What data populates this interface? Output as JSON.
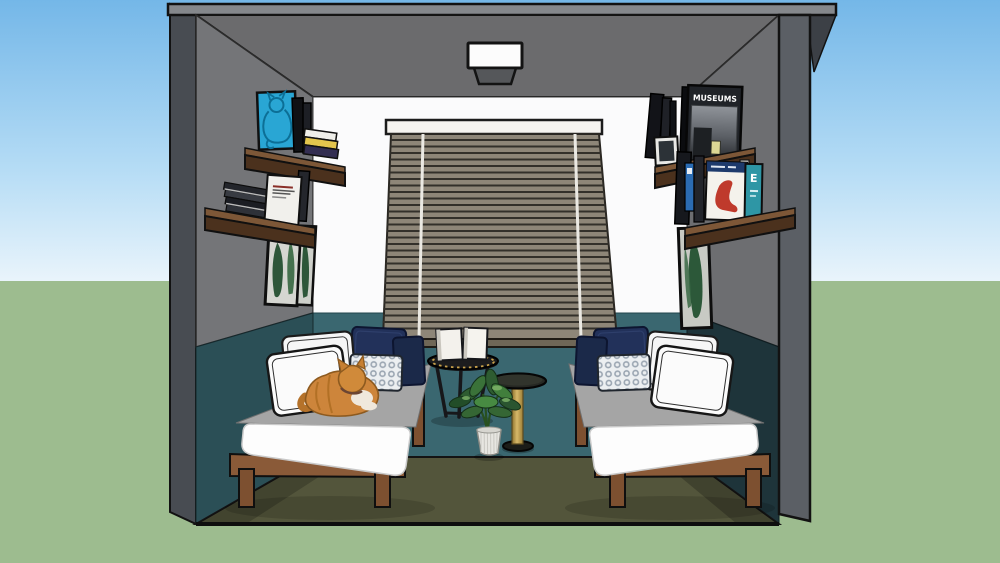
{
  "meta": {
    "scene_title": "Guest bedroom with twin daybeds — 3D dollhouse cutaway render",
    "render_style": "sketchup-like flat shading with black edge lines"
  },
  "environment": {
    "sky_top": "#74b7e8",
    "sky_mid": "#b5dcf5",
    "sky_horizon": "#e9f4fb",
    "ground": "#9dbc8f",
    "horizon_y_px": 281
  },
  "room": {
    "ceiling_color": "#6b6b6d",
    "side_wall_upper_color": "#747578",
    "back_wall_color": "#fbfbfc",
    "wainscot_back_color": "#3a6770",
    "wainscot_left_color": "#2b4f56",
    "wainscot_right_color": "#1e343a",
    "floor_color": "#53553b",
    "exterior_wall_color": "#484c52",
    "shelf_wood_color": "#7d5737",
    "bed_wood_color": "#8a5a38",
    "blind_slat_color": "#8e8678",
    "pillow_navy_color": "#22315a",
    "cat_color": "#cd853b",
    "art_print_blue": "#29a6d4",
    "book_teal_color": "#2e96a5",
    "chair_book_red": "#bf3a2c",
    "table_gold": "#c2a050"
  },
  "books": {
    "museums_cover_title": "MUSEUMS",
    "teal_book_letter": "E"
  },
  "objects": [
    "ceiling light",
    "window with venetian blinds",
    "floating shelves left with books and cat art print",
    "floating shelves right with MUSEUMS book and chair design book",
    "botanical framed prints",
    "daybed left with ginger cat",
    "daybed right",
    "round black side table with two books",
    "gold pedestal table",
    "potted plant"
  ]
}
